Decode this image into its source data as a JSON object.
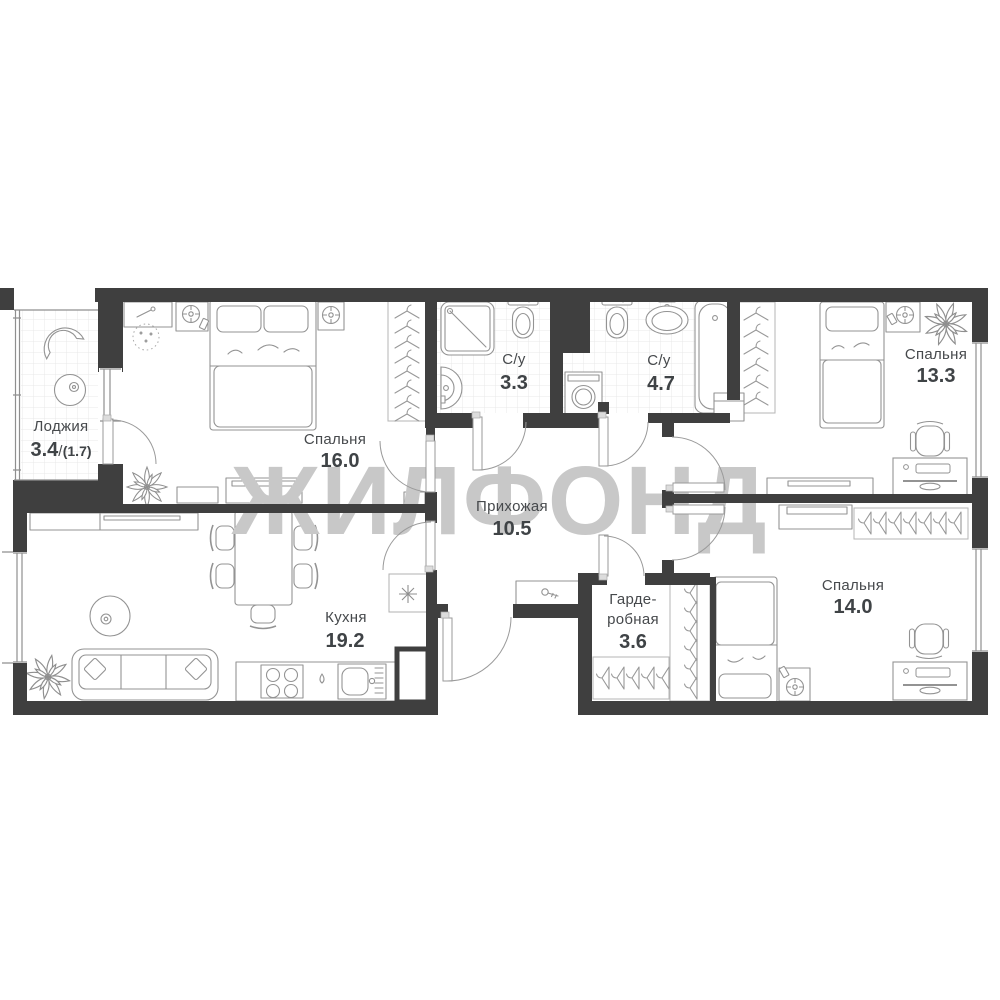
{
  "floorplan": {
    "watermark": "ЖИЛФОНД",
    "rooms": {
      "loggia": {
        "name": "Лоджия",
        "area": "3.4",
        "area_divider": "/",
        "area_secondary": "(1.7)"
      },
      "bedroom_1": {
        "name": "Спальня",
        "area": "16.0"
      },
      "bathroom_1": {
        "name": "С/у",
        "area": "3.3"
      },
      "bathroom_2": {
        "name": "С/у",
        "area": "4.7"
      },
      "bedroom_2": {
        "name": "Спальня",
        "area": "13.3"
      },
      "hallway": {
        "name": "Прихожая",
        "area": "10.5"
      },
      "kitchen": {
        "name": "Кухня",
        "area": "19.2"
      },
      "wardrobe": {
        "name_line1": "Гарде-",
        "name_line2": "робная",
        "area": "3.6"
      },
      "bedroom_3": {
        "name": "Спальня",
        "area": "14.0"
      }
    },
    "colors": {
      "wall": "#3f3f3f",
      "furniture_line": "#939393",
      "tile_line": "#e8e8e8",
      "watermark": "#c8c8c8",
      "label_text": "#46494c"
    }
  }
}
